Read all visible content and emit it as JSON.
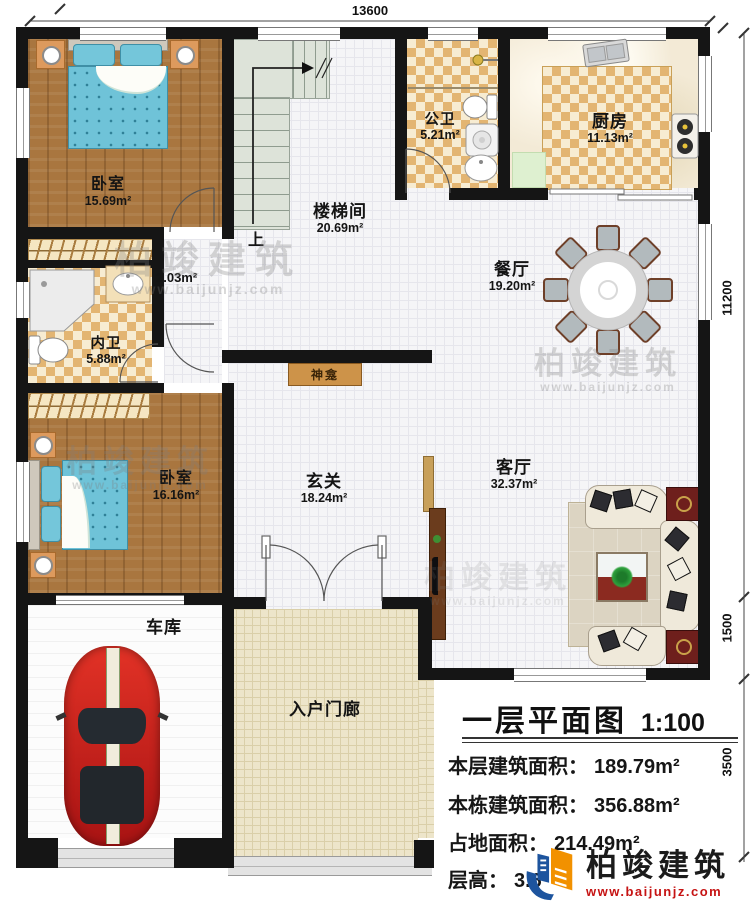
{
  "dims": {
    "top": "13600",
    "right_main": "11200",
    "right_living": "1500",
    "right_lower": "3500"
  },
  "rooms": {
    "bedroom1": {
      "name": "卧室",
      "area": "15.69m²"
    },
    "bath_public": {
      "name": "公卫",
      "area": "5.21m²"
    },
    "kitchen": {
      "name": "厨房",
      "area": "11.13m²"
    },
    "stairwell": {
      "name": "楼梯间",
      "area": "20.69m²"
    },
    "dining": {
      "name": "餐厅",
      "area": "19.20m²"
    },
    "bath_private": {
      "name": "内卫",
      "area": "5.88m²"
    },
    "bedroom2": {
      "name": "卧室",
      "area": "16.16m²"
    },
    "foyer": {
      "name": "玄关",
      "area": "18.24m²"
    },
    "living": {
      "name": "客厅",
      "area": "32.37m²"
    },
    "garage": {
      "name": "车库"
    },
    "porch": {
      "name": "入户门廊"
    }
  },
  "labels": {
    "up": "上",
    "nook_area": "2.03m²",
    "shrine": "神龛"
  },
  "titleblock": {
    "title": "一层平面图",
    "scale": "1:100",
    "stats": [
      {
        "label": "本层建筑面积：",
        "value": "189.79m²"
      },
      {
        "label": "本栋建筑面积：",
        "value": "356.88m²"
      },
      {
        "label": "占地面积：",
        "value": "214.49m²"
      },
      {
        "label": "层高：",
        "value": "3.6"
      }
    ]
  },
  "watermark": {
    "brand": "柏竣建筑",
    "url": "www.baijunjz.com"
  },
  "logo": {
    "brand": "柏竣建筑",
    "url": "www.baijunjz.com"
  }
}
